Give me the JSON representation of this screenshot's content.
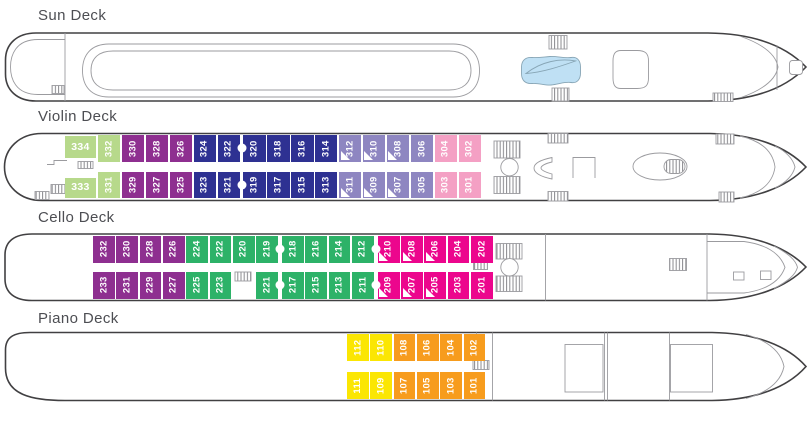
{
  "plan_title": "Ship deck plan",
  "colors": {
    "greenLight": "#b7d98b",
    "purple": "#8e2f90",
    "navy": "#2e3192",
    "lavender": "#8e86c1",
    "pinkLight": "#f4a0c4",
    "green": "#2db268",
    "magenta": "#ec068d",
    "yellow": "#fbe603",
    "orange": "#f79c1d",
    "poolBlue": "#bfe0f4",
    "hullLine": "#414042",
    "innerLine": "#9b9b9f",
    "titleText": "#4d4e53"
  },
  "icons": [
    "stairs-icon",
    "elevator-icon",
    "pool",
    "walking-track",
    "funnel",
    "whirlpool"
  ],
  "decks": [
    {
      "id": "sun",
      "title": "Sun Deck",
      "title_y": 7,
      "rows": {
        "top": 0,
        "bottom": 0,
        "h": 0
      },
      "cabin_w": 0,
      "cabins": [],
      "elevators": []
    },
    {
      "id": "violin",
      "title": "Violin Deck",
      "title_y": 108,
      "rows": {
        "top": 135,
        "bottom": 171.5,
        "h": 26.5
      },
      "cabin_w": 22.4,
      "cabins": [
        {
          "n": "334",
          "x": 65,
          "w": 31,
          "y": 135.5,
          "h": 22.5,
          "r": "t",
          "c": "greenLight",
          "o": "h"
        },
        {
          "n": "332",
          "x": 98,
          "r": "t",
          "c": "greenLight"
        },
        {
          "n": "330",
          "x": 121.9,
          "r": "t",
          "c": "purple"
        },
        {
          "n": "328",
          "x": 145.8,
          "r": "t",
          "c": "purple"
        },
        {
          "n": "326",
          "x": 169.7,
          "r": "t",
          "c": "purple"
        },
        {
          "n": "324",
          "x": 193.6,
          "r": "t",
          "c": "navy"
        },
        {
          "n": "322",
          "x": 217.5,
          "r": "t",
          "c": "navy"
        },
        {
          "n": "320",
          "x": 243.4,
          "r": "t",
          "c": "navy"
        },
        {
          "n": "318",
          "x": 267.3,
          "r": "t",
          "c": "navy"
        },
        {
          "n": "316",
          "x": 291.2,
          "r": "t",
          "c": "navy"
        },
        {
          "n": "314",
          "x": 315.1,
          "r": "t",
          "c": "navy"
        },
        {
          "n": "312",
          "x": 339,
          "r": "t",
          "c": "lavender",
          "tri": true
        },
        {
          "n": "310",
          "x": 362.9,
          "r": "t",
          "c": "lavender",
          "tri": true
        },
        {
          "n": "308",
          "x": 386.8,
          "r": "t",
          "c": "lavender",
          "tri": true
        },
        {
          "n": "306",
          "x": 410.7,
          "r": "t",
          "c": "lavender"
        },
        {
          "n": "304",
          "x": 434.6,
          "r": "t",
          "c": "pinkLight"
        },
        {
          "n": "302",
          "x": 458.5,
          "r": "t",
          "c": "pinkLight"
        },
        {
          "n": "333",
          "x": 65,
          "w": 31,
          "y": 177.5,
          "h": 20,
          "r": "b",
          "c": "greenLight",
          "o": "h"
        },
        {
          "n": "331",
          "x": 98,
          "r": "b",
          "c": "greenLight"
        },
        {
          "n": "329",
          "x": 121.9,
          "r": "b",
          "c": "purple"
        },
        {
          "n": "327",
          "x": 145.8,
          "r": "b",
          "c": "purple"
        },
        {
          "n": "325",
          "x": 169.7,
          "r": "b",
          "c": "purple"
        },
        {
          "n": "323",
          "x": 193.6,
          "r": "b",
          "c": "navy"
        },
        {
          "n": "321",
          "x": 217.5,
          "r": "b",
          "c": "navy"
        },
        {
          "n": "319",
          "x": 243.4,
          "r": "b",
          "c": "navy"
        },
        {
          "n": "317",
          "x": 267.3,
          "r": "b",
          "c": "navy"
        },
        {
          "n": "315",
          "x": 291.2,
          "r": "b",
          "c": "navy"
        },
        {
          "n": "313",
          "x": 315.1,
          "r": "b",
          "c": "navy"
        },
        {
          "n": "311",
          "x": 339,
          "r": "b",
          "c": "lavender",
          "tri": true
        },
        {
          "n": "309",
          "x": 362.9,
          "r": "b",
          "c": "lavender",
          "tri": true
        },
        {
          "n": "307",
          "x": 386.8,
          "r": "b",
          "c": "lavender",
          "tri": true
        },
        {
          "n": "305",
          "x": 410.7,
          "r": "b",
          "c": "lavender"
        },
        {
          "n": "303",
          "x": 434.6,
          "r": "b",
          "c": "pinkLight"
        },
        {
          "n": "301",
          "x": 458.5,
          "r": "b",
          "c": "pinkLight"
        }
      ],
      "elevators": [
        {
          "x": 241.7
        }
      ]
    },
    {
      "id": "cello",
      "title": "Cello Deck",
      "title_y": 209,
      "rows": {
        "top": 235.5,
        "bottom": 271.5,
        "h": 27
      },
      "cabin_w": 21.8,
      "cabins": [
        {
          "n": "232",
          "x": 93,
          "r": "t",
          "c": "purple"
        },
        {
          "n": "230",
          "x": 116.3,
          "r": "t",
          "c": "purple"
        },
        {
          "n": "228",
          "x": 139.6,
          "r": "t",
          "c": "purple"
        },
        {
          "n": "226",
          "x": 162.9,
          "r": "t",
          "c": "purple"
        },
        {
          "n": "224",
          "x": 186.2,
          "r": "t",
          "c": "green"
        },
        {
          "n": "222",
          "x": 209.5,
          "r": "t",
          "c": "green"
        },
        {
          "n": "220",
          "x": 232.8,
          "r": "t",
          "c": "green"
        },
        {
          "n": "219",
          "x": 256.1,
          "r": "t",
          "c": "green"
        },
        {
          "n": "218",
          "x": 282,
          "r": "t",
          "c": "green"
        },
        {
          "n": "216",
          "x": 305.3,
          "r": "t",
          "c": "green"
        },
        {
          "n": "214",
          "x": 328.6,
          "r": "t",
          "c": "green"
        },
        {
          "n": "212",
          "x": 351.9,
          "r": "t",
          "c": "green"
        },
        {
          "n": "210",
          "x": 377.8,
          "r": "t",
          "c": "magenta",
          "tri": true
        },
        {
          "n": "208",
          "x": 401.1,
          "r": "t",
          "c": "magenta",
          "tri": true
        },
        {
          "n": "206",
          "x": 424.4,
          "r": "t",
          "c": "magenta",
          "tri": true
        },
        {
          "n": "204",
          "x": 447.7,
          "r": "t",
          "c": "magenta"
        },
        {
          "n": "202",
          "x": 471,
          "r": "t",
          "c": "magenta"
        },
        {
          "n": "233",
          "x": 93,
          "r": "b",
          "c": "purple"
        },
        {
          "n": "231",
          "x": 116.3,
          "r": "b",
          "c": "purple"
        },
        {
          "n": "229",
          "x": 139.6,
          "r": "b",
          "c": "purple"
        },
        {
          "n": "227",
          "x": 162.9,
          "r": "b",
          "c": "purple"
        },
        {
          "n": "225",
          "x": 186.2,
          "r": "b",
          "c": "green"
        },
        {
          "n": "223",
          "x": 209.5,
          "r": "b",
          "c": "green"
        },
        {
          "n": "221",
          "x": 256.1,
          "r": "b",
          "c": "green"
        },
        {
          "n": "217",
          "x": 282,
          "r": "b",
          "c": "green"
        },
        {
          "n": "215",
          "x": 305.3,
          "r": "b",
          "c": "green"
        },
        {
          "n": "213",
          "x": 328.6,
          "r": "b",
          "c": "green"
        },
        {
          "n": "211",
          "x": 351.9,
          "r": "b",
          "c": "green"
        },
        {
          "n": "209",
          "x": 377.8,
          "r": "b",
          "c": "magenta",
          "tri": true
        },
        {
          "n": "207",
          "x": 401.1,
          "r": "b",
          "c": "magenta",
          "tri": true
        },
        {
          "n": "205",
          "x": 424.4,
          "r": "b",
          "c": "magenta",
          "tri": true
        },
        {
          "n": "203",
          "x": 447.7,
          "r": "b",
          "c": "magenta"
        },
        {
          "n": "201",
          "x": 471,
          "r": "b",
          "c": "magenta"
        }
      ],
      "elevators": [
        {
          "x": 280
        },
        {
          "x": 375.5
        }
      ]
    },
    {
      "id": "piano",
      "title": "Piano Deck",
      "title_y": 310,
      "rows": {
        "top": 334,
        "bottom": 372,
        "h": 27
      },
      "cabin_w": 21.8,
      "cabins": [
        {
          "n": "112",
          "x": 347,
          "r": "t",
          "c": "yellow"
        },
        {
          "n": "110",
          "x": 370.3,
          "r": "t",
          "c": "yellow"
        },
        {
          "n": "108",
          "x": 393.6,
          "r": "t",
          "c": "orange"
        },
        {
          "n": "106",
          "x": 416.9,
          "r": "t",
          "c": "orange"
        },
        {
          "n": "104",
          "x": 440.2,
          "r": "t",
          "c": "orange"
        },
        {
          "n": "102",
          "x": 463.5,
          "r": "t",
          "c": "orange"
        },
        {
          "n": "111",
          "x": 347,
          "r": "b",
          "c": "yellow"
        },
        {
          "n": "109",
          "x": 370.3,
          "r": "b",
          "c": "yellow"
        },
        {
          "n": "107",
          "x": 393.6,
          "r": "b",
          "c": "orange"
        },
        {
          "n": "105",
          "x": 416.9,
          "r": "b",
          "c": "orange"
        },
        {
          "n": "103",
          "x": 440.2,
          "r": "b",
          "c": "orange"
        },
        {
          "n": "101",
          "x": 463.5,
          "r": "b",
          "c": "orange"
        }
      ],
      "elevators": []
    }
  ]
}
